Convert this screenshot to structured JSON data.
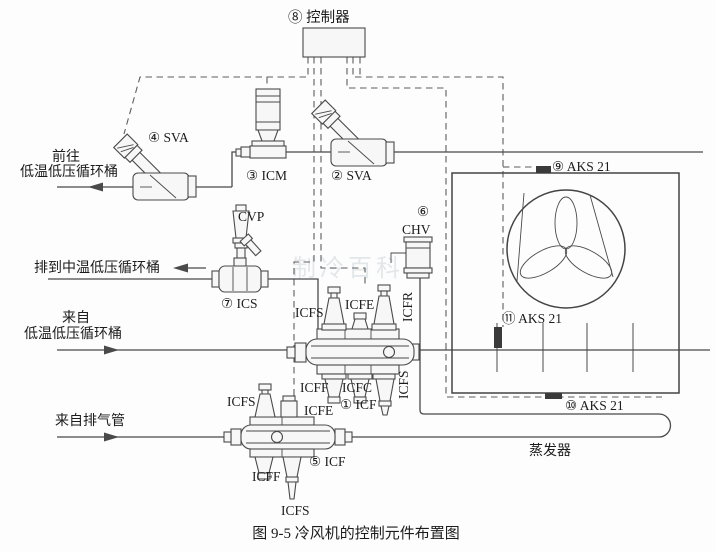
{
  "labels": {
    "controller": "⑧ 控制器",
    "sva4": "④ SVA",
    "dest_lt_line1": "前往",
    "dest_lt_line2": "低温低压循环桶",
    "icm3": "③ ICM",
    "sva2": "② SVA",
    "cvp": "CVP",
    "drain_mt": "排到中温低压循环桶",
    "ics7": "⑦ ICS",
    "chv_num": "⑥",
    "chv": "CHV",
    "aks9": "⑨ AKS 21",
    "aks11": "⑪ AKS 21",
    "aks10": "⑩ AKS 21",
    "from_lt_line1": "来自",
    "from_lt_line2": "低温低压循环桶",
    "from_discharge": "来自排气管",
    "evaporator": "蒸发器",
    "caption": "图 9-5  冷风机的控制元件布置图",
    "watermark": "制冷百科"
  },
  "station1": {
    "icfs_top": "ICFS",
    "icfe": "ICFE",
    "icfr": "ICFR",
    "icff": "ICFF",
    "icfc": "ICFC",
    "name": "① ICF",
    "icfs_bottom": "ICFS"
  },
  "station5": {
    "icfs_top": "ICFS",
    "icfe": "ICFE",
    "name": "⑤ ICF",
    "icff": "ICFF",
    "icfs_bottom": "ICFS"
  },
  "colors": {
    "line": "#4a4a4a",
    "dashed": "#5d5d5d",
    "sensor": "#3a3a3a",
    "background": "#fdfdfd",
    "watermark": "#b9c4cc"
  }
}
